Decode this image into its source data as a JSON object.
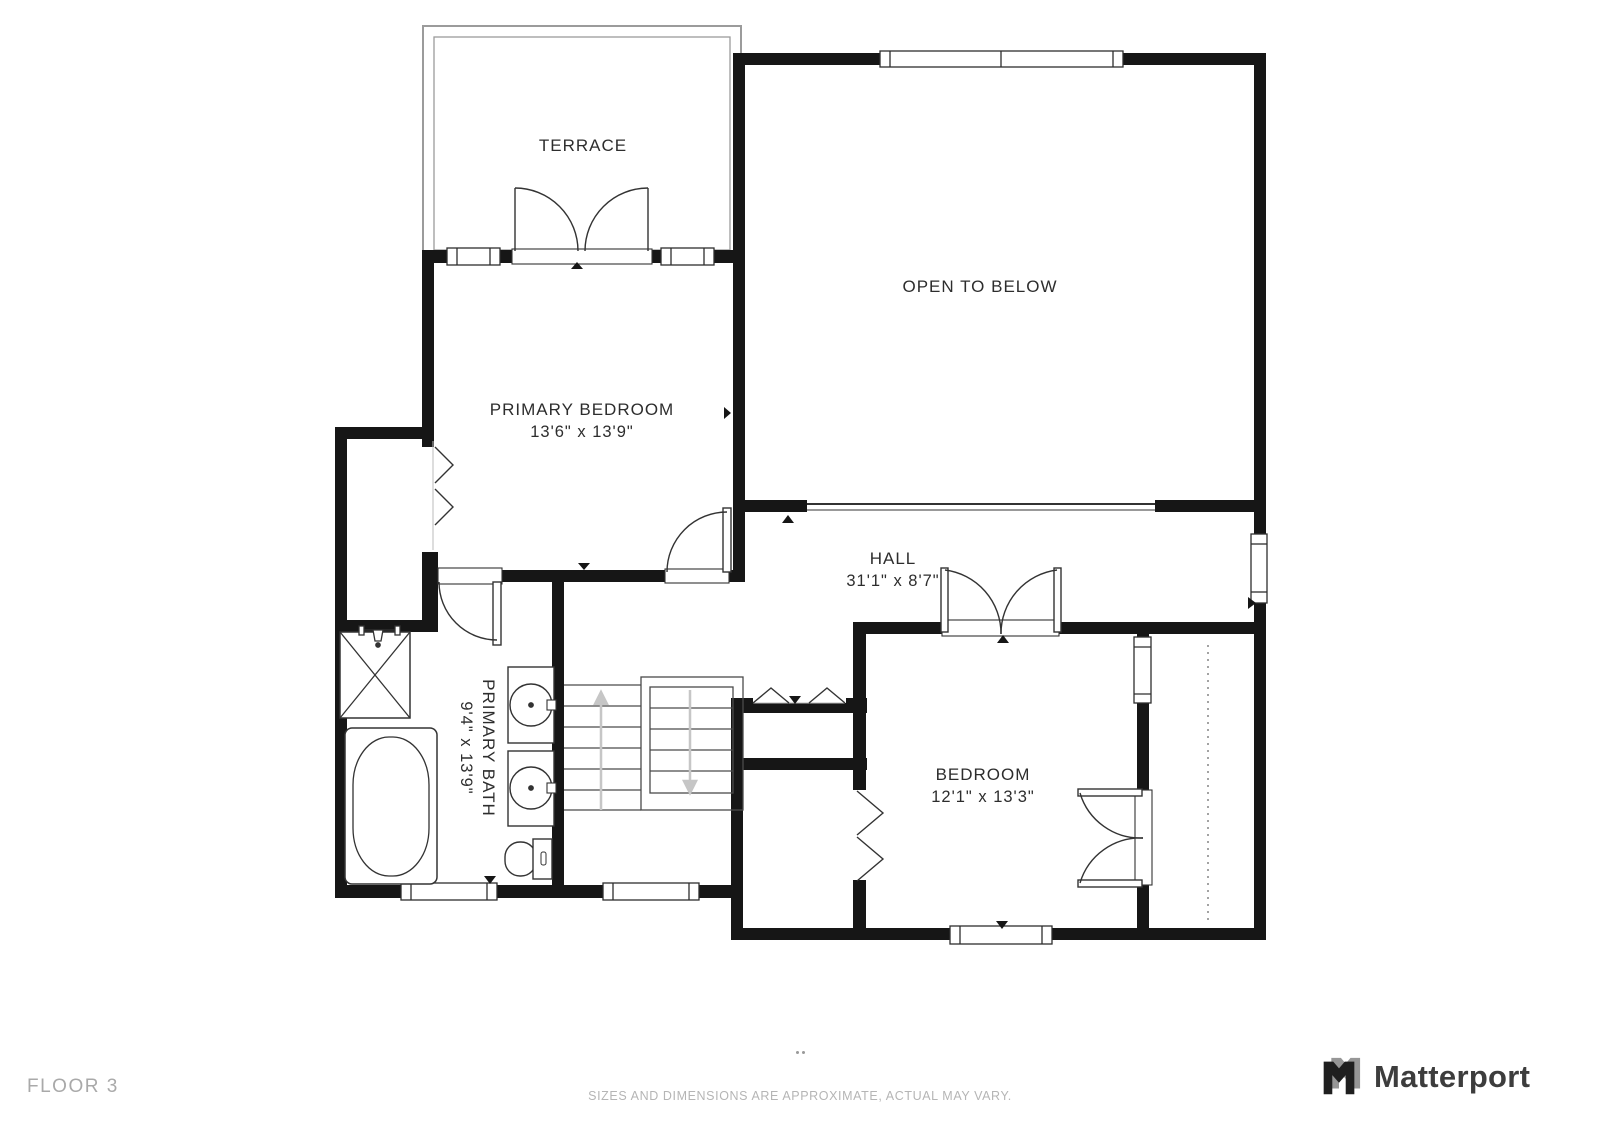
{
  "meta": {
    "floor_label": "FLOOR 3",
    "disclaimer": "SIZES AND DIMENSIONS ARE APPROXIMATE, ACTUAL MAY VARY.",
    "brand": "Matterport"
  },
  "rooms": {
    "terrace": {
      "name": "TERRACE"
    },
    "primary_bedroom": {
      "name": "PRIMARY BEDROOM",
      "dimensions": "13'6\" x 13'9\""
    },
    "open_to_below": {
      "name": "OPEN TO BELOW"
    },
    "hall": {
      "name": "HALL",
      "dimensions": "31'1\" x 8'7\""
    },
    "primary_bath": {
      "name": "PRIMARY BATH",
      "dimensions": "9'4\" x 13'9\""
    },
    "bedroom": {
      "name": "BEDROOM",
      "dimensions": "12'1\" x 13'3\""
    }
  },
  "fixtures": [
    "staircase",
    "shower",
    "bathtub",
    "sink",
    "sink",
    "toilet",
    "closet-rod"
  ],
  "colors": {
    "wall": "#161616",
    "line": "#333333",
    "terrace_frame": "#9b9b9b",
    "stair_arrow": "#c6c6c6",
    "label_text": "#2d2d2d",
    "floor_text": "#a9a9a9",
    "disclaimer_text": "#b5b5b5",
    "brand_text": "#3d3d3d"
  }
}
